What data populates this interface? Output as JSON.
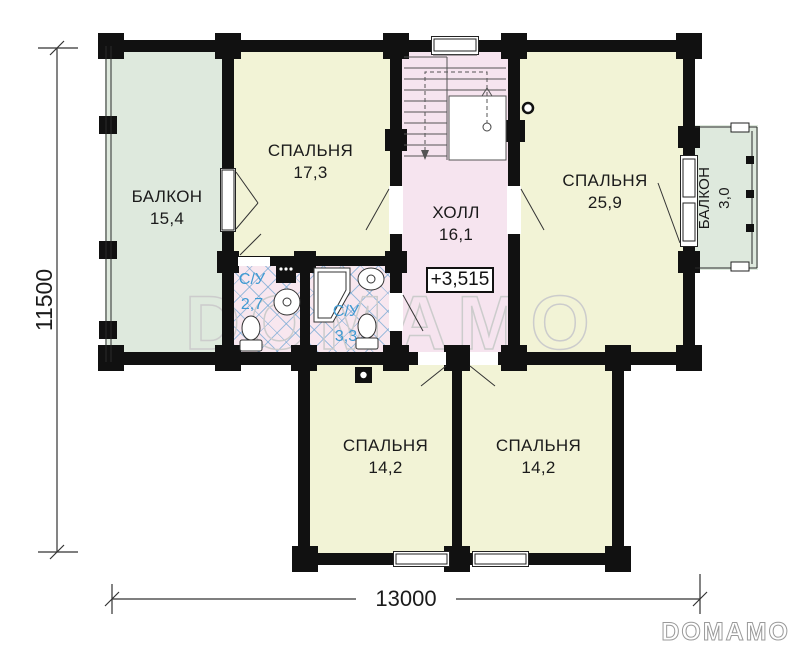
{
  "rooms": {
    "balcony_left": {
      "name": "БАЛКОН",
      "area": "15,4"
    },
    "bedroom_1": {
      "name": "СПАЛЬНЯ",
      "area": "17,3"
    },
    "hall": {
      "name": "ХОЛЛ",
      "area": "16,1"
    },
    "bedroom_2": {
      "name": "СПАЛЬНЯ",
      "area": "25,9"
    },
    "balcony_right": {
      "name": "БАЛКОН",
      "area": "3,0"
    },
    "wc_1": {
      "name": "С/У",
      "area": "2,7"
    },
    "wc_2": {
      "name": "С/У",
      "area": "3,3"
    },
    "bedroom_3": {
      "name": "СПАЛЬНЯ",
      "area": "14,2"
    },
    "bedroom_4": {
      "name": "СПАЛЬНЯ",
      "area": "14,2"
    }
  },
  "annotations": {
    "elevation": "+3,515"
  },
  "dimensions": {
    "vertical": "11500",
    "horizontal": "13000"
  },
  "branding": {
    "watermark": "DOMAMO",
    "logo": "DOMAMO"
  },
  "colors": {
    "wall": "#111111",
    "room_yellow": "#f2f3d6",
    "balcony_green": "#dee9dd",
    "hall_pink": "#f6e4ef",
    "bath_pink": "#f8e7ef",
    "tile_blue": "#6ea5d2",
    "wc_label_blue": "#3f9ad2",
    "watermark_gray": "#cccccc"
  }
}
